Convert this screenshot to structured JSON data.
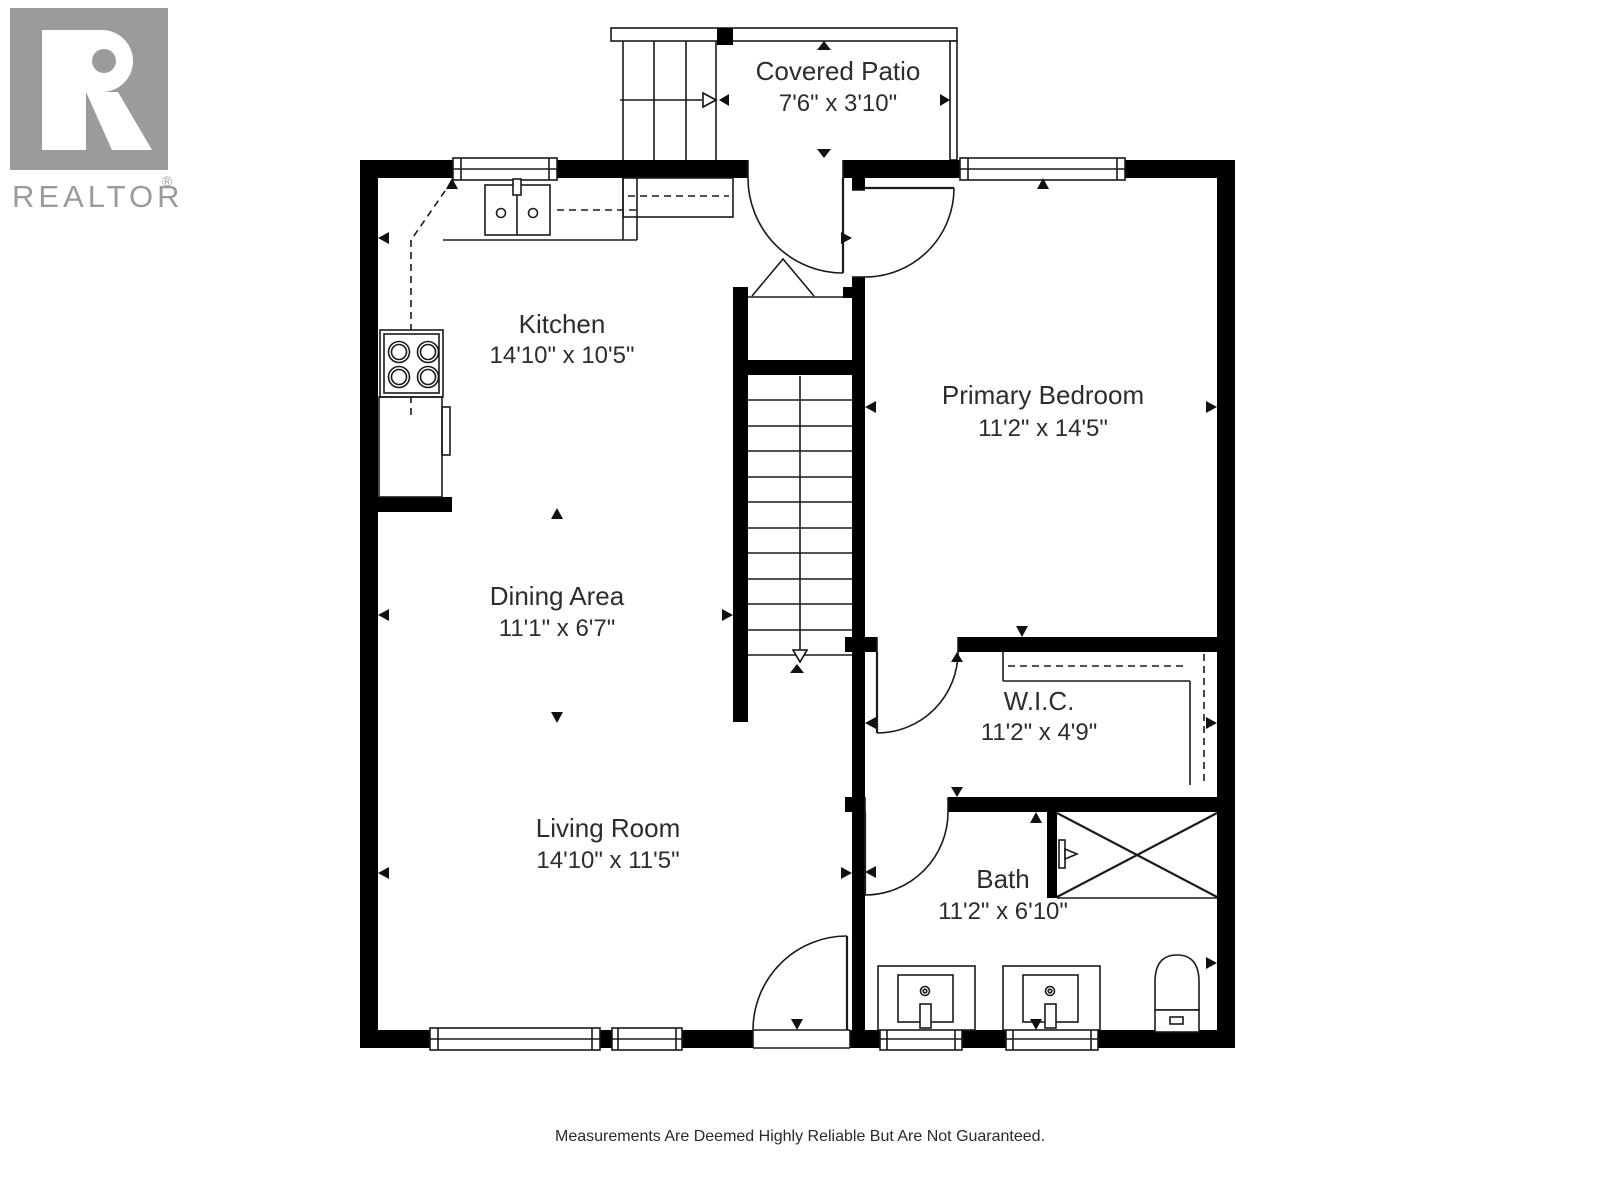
{
  "branding": {
    "logo_name": "REALTOR",
    "registered_symbol": "®"
  },
  "rooms": {
    "covered_patio": {
      "name": "Covered Patio",
      "dimensions": "7'6\" x 3'10\""
    },
    "kitchen": {
      "name": "Kitchen",
      "dimensions": "14'10\" x 10'5\""
    },
    "primary_bedroom": {
      "name": "Primary Bedroom",
      "dimensions": "11'2\" x 14'5\""
    },
    "dining_area": {
      "name": "Dining Area",
      "dimensions": "11'1\" x 6'7\""
    },
    "wic": {
      "name": "W.I.C.",
      "dimensions": "11'2\" x 4'9\""
    },
    "living_room": {
      "name": "Living Room",
      "dimensions": "14'10\" x 11'5\""
    },
    "bath": {
      "name": "Bath",
      "dimensions": "11'2\" x 6'10\""
    }
  },
  "footer": {
    "disclaimer": "Measurements Are Deemed Highly Reliable But Are Not Guaranteed."
  },
  "colors": {
    "walls": "#000000",
    "logo_gray": "#9b9b9b",
    "label_text": "#2d2d2d",
    "background": "#ffffff"
  }
}
